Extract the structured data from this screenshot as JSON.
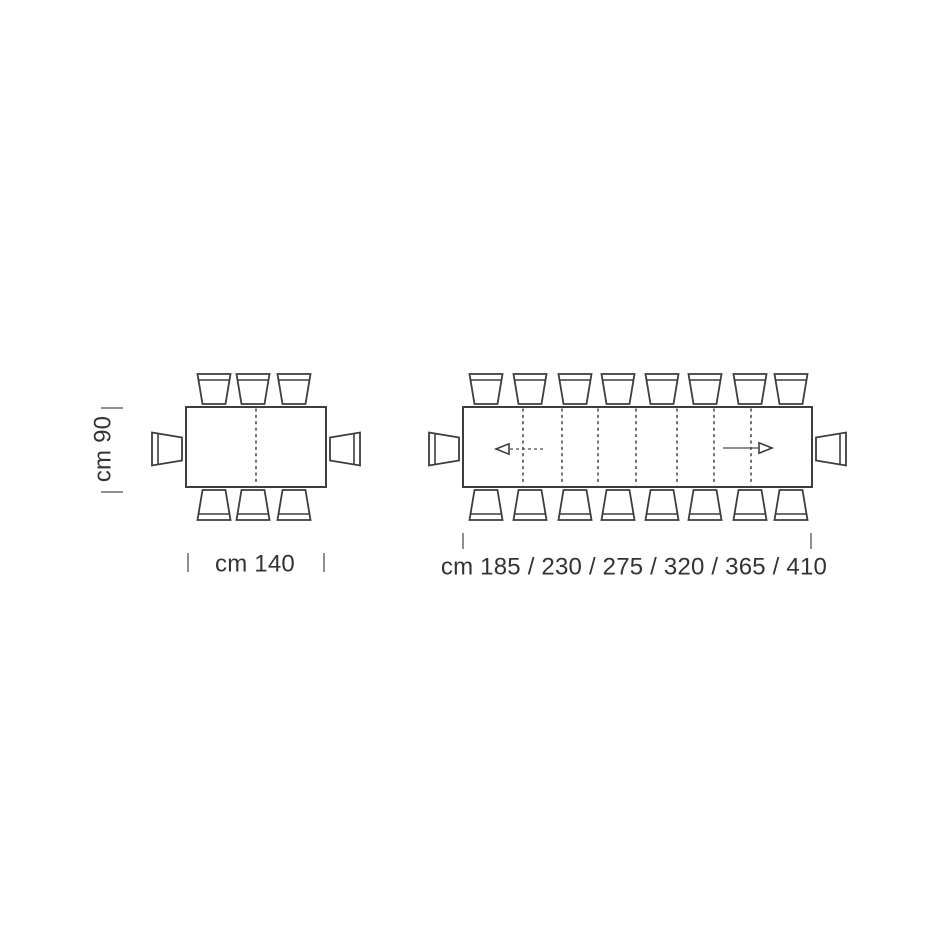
{
  "page": {
    "background": "#ffffff",
    "description": "top-view dimension diagram of a fixed table and an extendable table with chairs"
  },
  "style": {
    "line_color": "#3d3d3d",
    "fold_line_color": "#4c4c4c",
    "tick_color": "#8f8f8f",
    "text_color": "#333333",
    "arrow_color": "#4c4c4c",
    "fill_color": "#ffffff"
  },
  "diagram": {
    "units": "cm",
    "chair": {
      "width": 33,
      "depth": 30,
      "inset": 5,
      "band": 6,
      "gap": 3,
      "side_gap": 4
    },
    "tables": [
      {
        "id": "fixed-table",
        "x": 186,
        "y": 407,
        "w": 140,
        "h": 80,
        "fold_lines_x": [
          256
        ],
        "chairs_top_x": [
          214,
          253,
          294
        ],
        "chairs_bottom_x": [
          214,
          253,
          294
        ],
        "chairs_left_y": [
          449
        ],
        "chairs_right_y": [
          449
        ],
        "arrows": []
      },
      {
        "id": "extending-table",
        "x": 463,
        "y": 407,
        "w": 349,
        "h": 80,
        "fold_lines_x": [
          523,
          562,
          598,
          636,
          677,
          714,
          751
        ],
        "chairs_top_x": [
          486,
          530,
          575,
          618,
          662,
          705,
          750,
          791
        ],
        "chairs_bottom_x": [
          486,
          530,
          575,
          618,
          662,
          705,
          750,
          791
        ],
        "chairs_left_y": [
          449
        ],
        "chairs_right_y": [
          449
        ],
        "arrows": [
          {
            "id": "extension-arrow-left",
            "tip_x": 496,
            "tail_x": 543,
            "y": 449,
            "line": "dashed"
          },
          {
            "id": "extension-arrow-right",
            "tip_x": 772,
            "tail_x": 723,
            "y": 448,
            "line": "solid"
          }
        ]
      }
    ],
    "dimensions": {
      "height": {
        "label": "cm 90",
        "value_cm": 90,
        "rotated": true,
        "text_center": {
          "x": 103,
          "y": 449
        },
        "ticks": [
          {
            "x1": 101,
            "y1": 408,
            "x2": 123,
            "y2": 408
          },
          {
            "x1": 101,
            "y1": 492,
            "x2": 123,
            "y2": 492
          }
        ]
      },
      "fixed_length": {
        "label": "cm 140",
        "value_cm": 140,
        "text_center": {
          "x": 255,
          "y": 564
        },
        "ticks": [
          {
            "x1": 188,
            "y1": 553,
            "x2": 188,
            "y2": 572
          },
          {
            "x1": 324,
            "y1": 553,
            "x2": 324,
            "y2": 572
          }
        ]
      },
      "extension_lengths": {
        "label": "cm 185 / 230 / 275 / 320 / 365 / 410",
        "values_cm": [
          185,
          230,
          275,
          320,
          365,
          410
        ],
        "text_center": {
          "x": 634,
          "y": 567
        },
        "ticks": [
          {
            "x1": 463,
            "y1": 533,
            "x2": 463,
            "y2": 549
          },
          {
            "x1": 811,
            "y1": 533,
            "x2": 811,
            "y2": 549
          }
        ]
      }
    }
  }
}
